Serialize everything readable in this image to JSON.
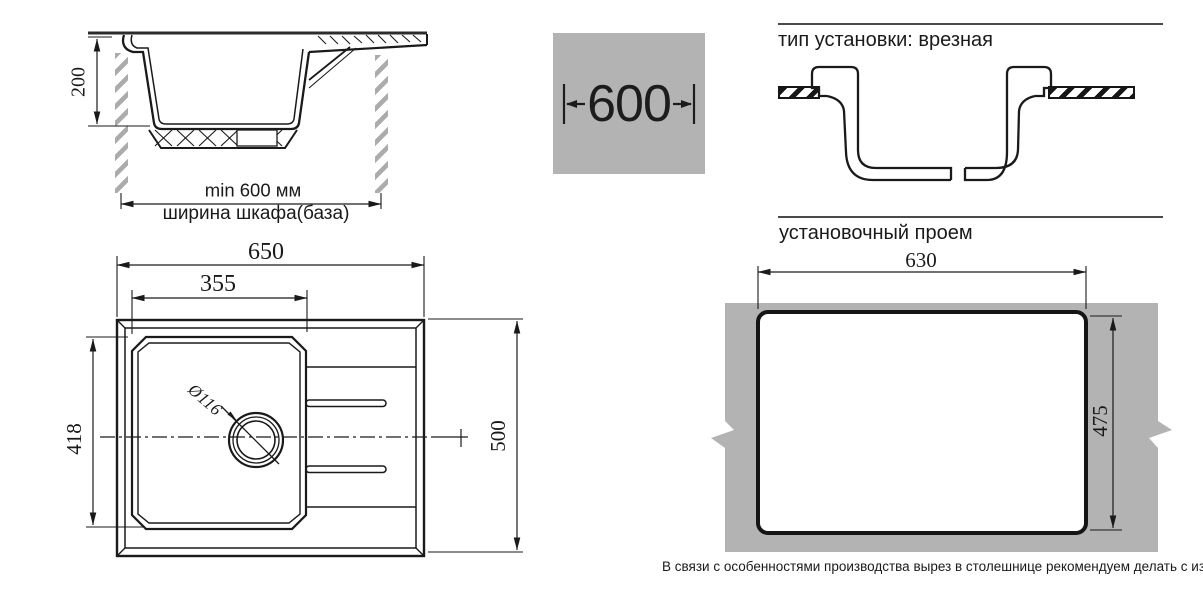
{
  "section_view": {
    "depth_label": "200",
    "min_width_label": "min 600 мм",
    "cabinet_label": "ширина шкафа(база)"
  },
  "cabinet_badge": {
    "width": "600"
  },
  "installation": {
    "title": "тип установки: врезная"
  },
  "opening": {
    "title": "установочный проем",
    "width_label": "630",
    "height_label": "475"
  },
  "top_view": {
    "overall_width_label": "650",
    "bowl_width_label": "355",
    "bowl_height_label": "418",
    "overall_depth_label": "500",
    "drain_label": "Ø116"
  },
  "footnote": "В связи с особенностями производства вырез в столешнице рекомендуем делать с изделия.",
  "colors": {
    "panel_gray": "#b3b3b3",
    "hatch_gray": "#ababab",
    "line": "#1a1a1a",
    "rule": "#4a4a4a"
  }
}
